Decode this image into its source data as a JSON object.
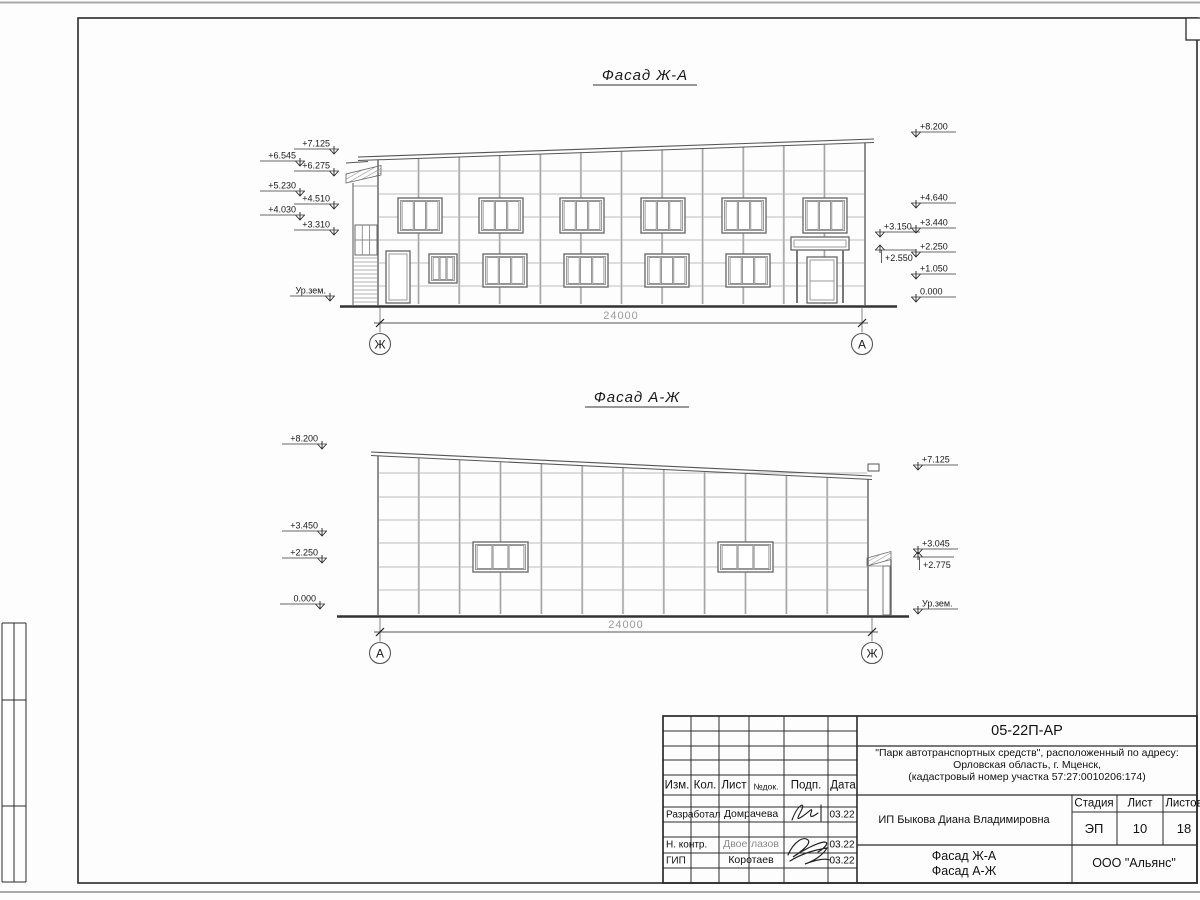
{
  "sheet": {
    "facade1": {
      "title": "Фасад Ж-А",
      "dimension_label": "24000",
      "axis_left": "Ж",
      "axis_right": "А",
      "marks": [
        {
          "label": "+6.545",
          "x": 300,
          "y": 161,
          "dir": "r"
        },
        {
          "label": "+5.230",
          "x": 300,
          "y": 191,
          "dir": "r"
        },
        {
          "label": "+4.030",
          "x": 300,
          "y": 215,
          "dir": "r"
        },
        {
          "label": "+7.125",
          "x": 334,
          "y": 149,
          "dir": "r"
        },
        {
          "label": "+6.275",
          "x": 334,
          "y": 171,
          "dir": "r"
        },
        {
          "label": "+4.510",
          "x": 334,
          "y": 204,
          "dir": "r"
        },
        {
          "label": "+3.310",
          "x": 334,
          "y": 230,
          "dir": "r"
        },
        {
          "label": "Ур.зем.",
          "x": 330,
          "y": 296,
          "dir": "r"
        },
        {
          "label": "+3.150",
          "x": 880,
          "y": 232,
          "dir": "l"
        },
        {
          "label": "+2.550",
          "x": 880,
          "y": 250,
          "dir": "lU"
        },
        {
          "label": "+8.200",
          "x": 916,
          "y": 132,
          "dir": "l"
        },
        {
          "label": "+4.640",
          "x": 916,
          "y": 203,
          "dir": "l"
        },
        {
          "label": "+3.440",
          "x": 916,
          "y": 228,
          "dir": "l"
        },
        {
          "label": "+2.250",
          "x": 916,
          "y": 252,
          "dir": "l"
        },
        {
          "label": "+1.050",
          "x": 916,
          "y": 274,
          "dir": "l"
        },
        {
          "label": "0.000",
          "x": 916,
          "y": 297,
          "dir": "l"
        }
      ]
    },
    "facade2": {
      "title": "Фасад А-Ж",
      "dimension_label": "24000",
      "axis_left": "А",
      "axis_right": "Ж",
      "marks": [
        {
          "label": "+8.200",
          "x": 322,
          "y": 444,
          "dir": "r"
        },
        {
          "label": "+3.450",
          "x": 322,
          "y": 531,
          "dir": "r"
        },
        {
          "label": "+2.250",
          "x": 322,
          "y": 558,
          "dir": "r"
        },
        {
          "label": "0.000",
          "x": 320,
          "y": 604,
          "dir": "r"
        },
        {
          "label": "+7.125",
          "x": 918,
          "y": 465,
          "dir": "l"
        },
        {
          "label": "+3.045",
          "x": 918,
          "y": 549,
          "dir": "l"
        },
        {
          "label": "+2.775",
          "x": 918,
          "y": 557,
          "dir": "lU"
        },
        {
          "label": "Ур.зем.",
          "x": 918,
          "y": 609,
          "dir": "l"
        }
      ]
    }
  },
  "titleblock": {
    "doc_number": "05-22П-АР",
    "project_line1": "\"Парк автотранспортных средств\",  расположенный по адресу:",
    "project_line2": "Орловская область, г. Мценск,",
    "project_line3": "(кадастровый номер участка 57:27:0010206:174)",
    "client": "ИП Быкова Диана Владимировна",
    "cols": {
      "izm": "Изм.",
      "kol": "Кол.",
      "list": "Лист",
      "ndok": "№док.",
      "podp": "Подп.",
      "data": "Дата"
    },
    "rows": [
      {
        "role": "Разработал",
        "name": "Домрачева",
        "date": "03.22"
      },
      {
        "role": "Н. контр.",
        "name": "Двоеглазов",
        "date": "03.22"
      },
      {
        "role": "ГИП",
        "name": "Коротаев",
        "date": "03.22"
      }
    ],
    "stage_label": "Стадия",
    "sheet_label": "Лист",
    "sheets_label": "Листов",
    "stage": "ЭП",
    "sheet": "10",
    "sheets": "18",
    "sheet_title_line1": "Фасад Ж-А",
    "sheet_title_line2": "Фасад А-Ж",
    "organization": "ООО \"Альянс\""
  }
}
